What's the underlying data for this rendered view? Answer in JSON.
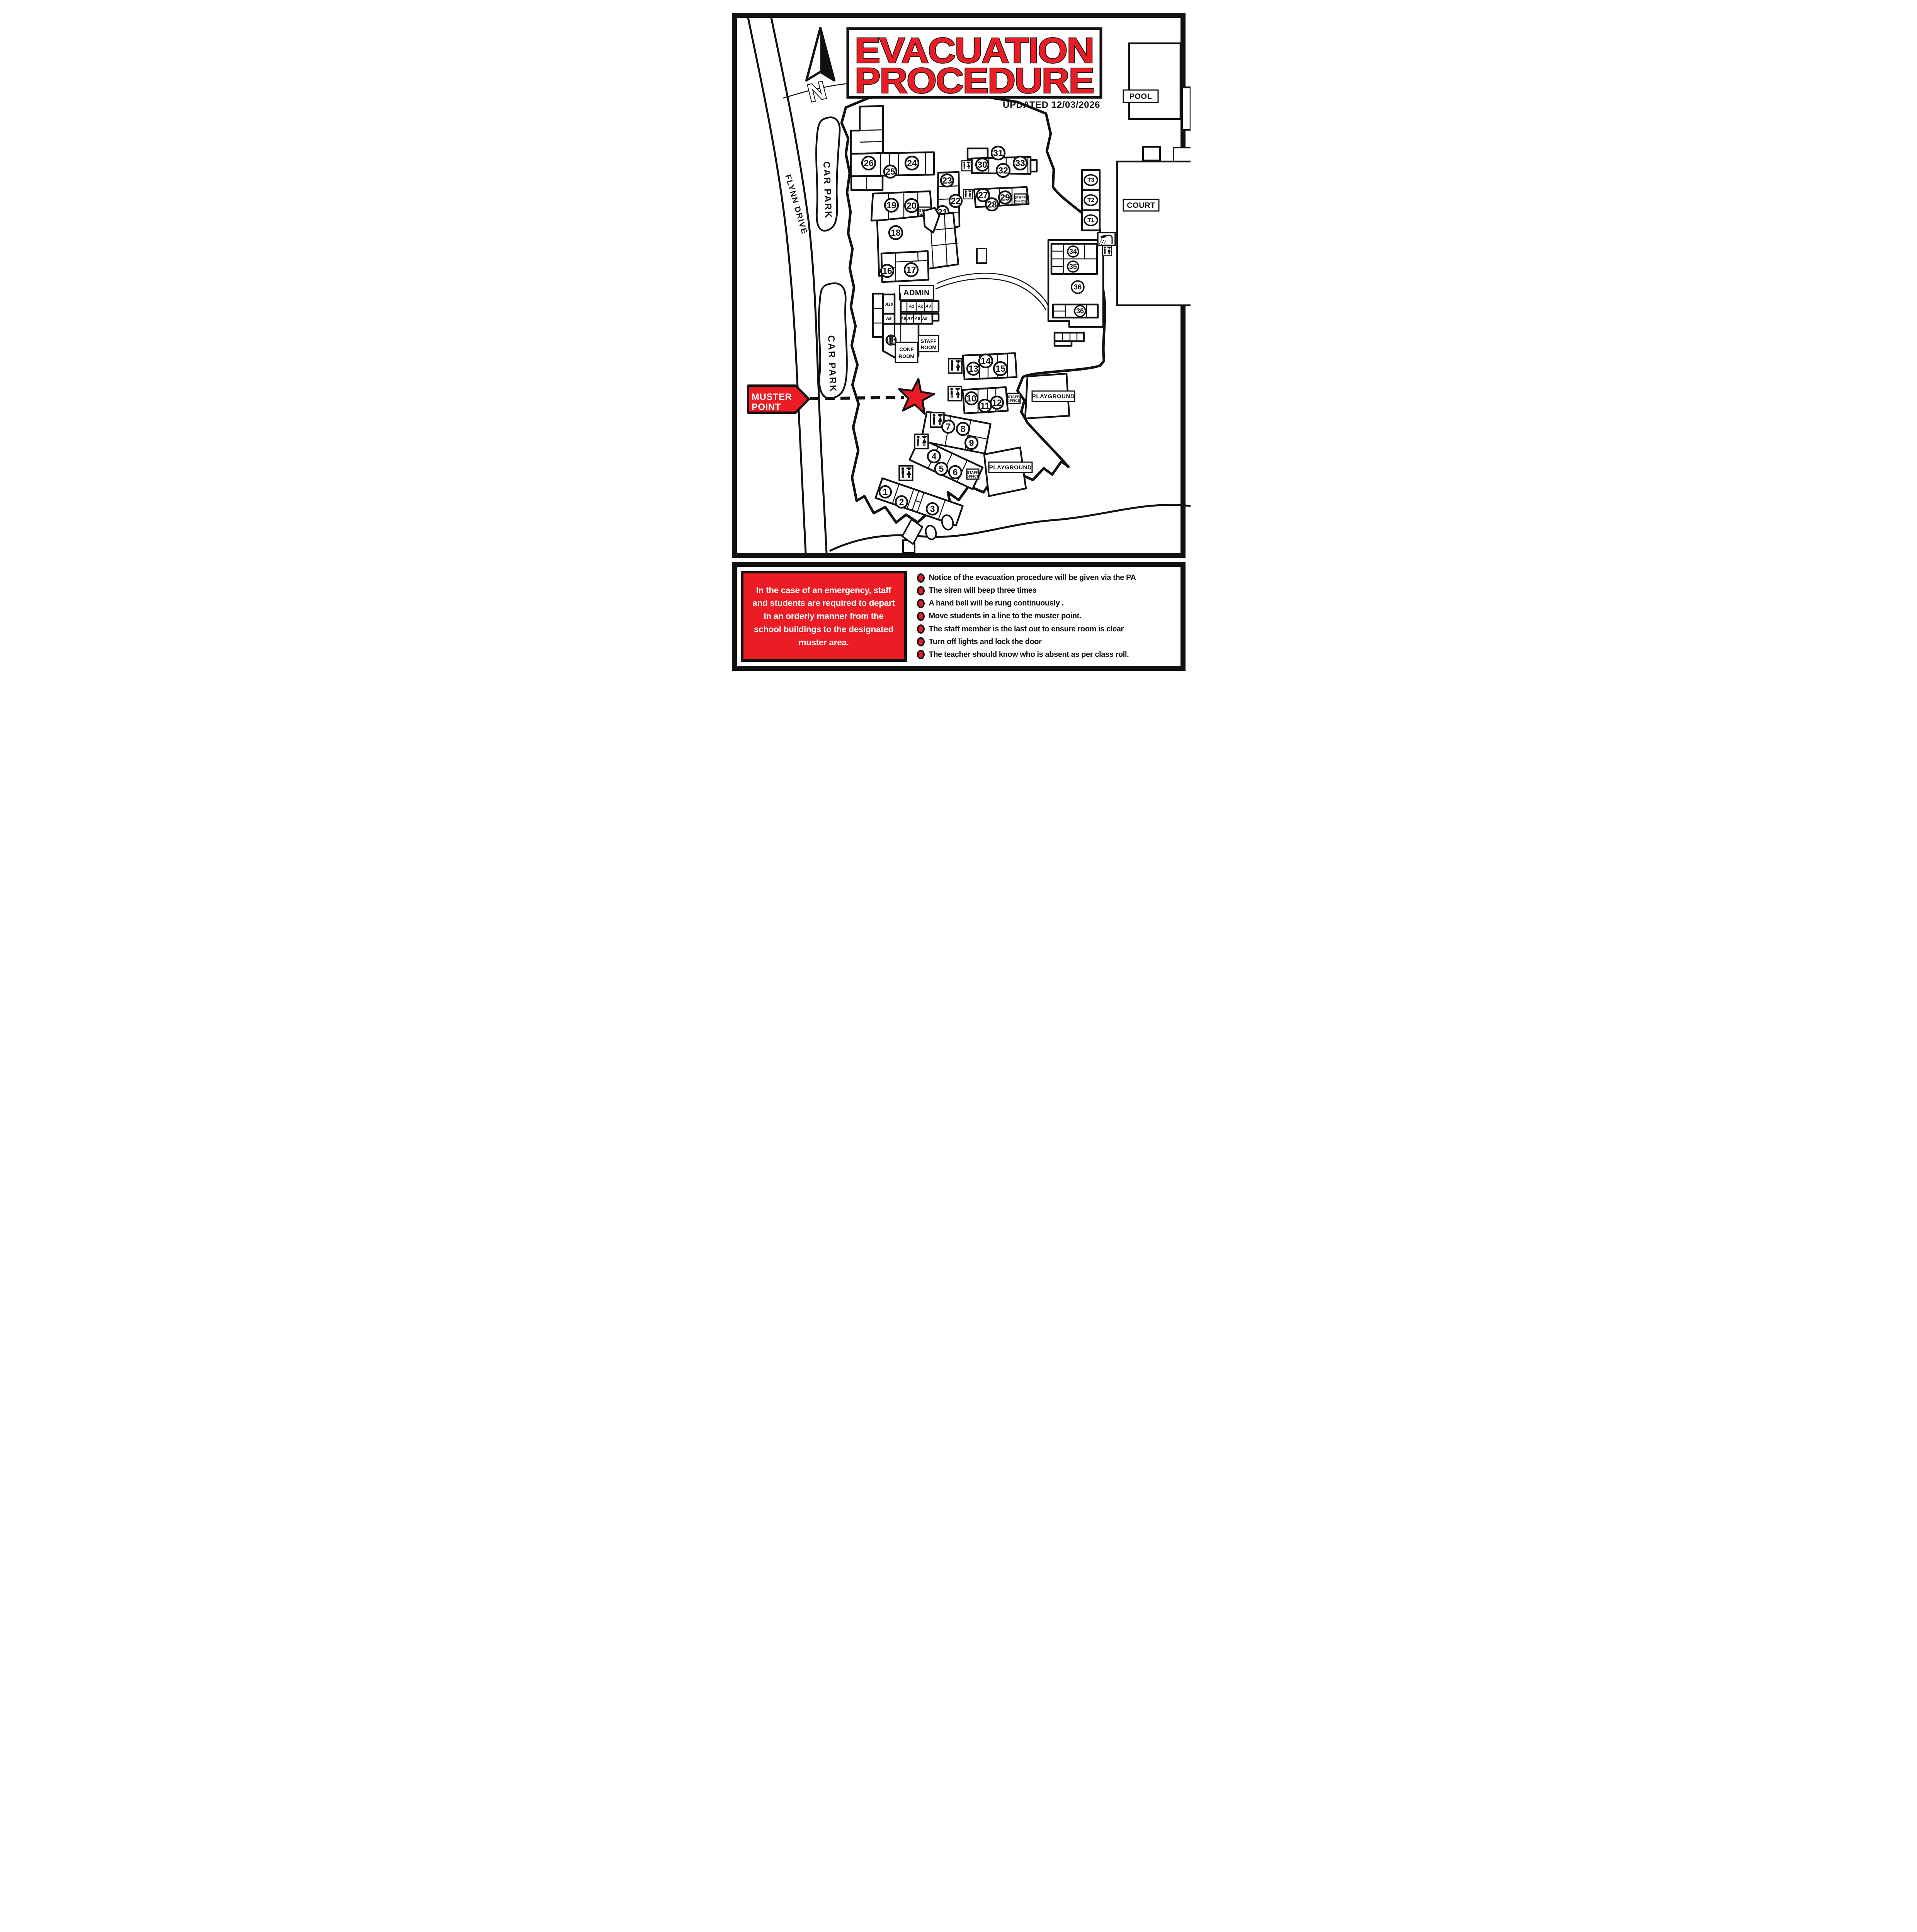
{
  "title": {
    "line1": "EVACUATION",
    "line2": "PROCEDURE",
    "updated": "UPDATED 12/03/2026"
  },
  "map": {
    "labels": {
      "north": "N",
      "pool": "POOL",
      "court": "COURT",
      "car_park": "CAR PARK",
      "flynn_drive": "FLYNN DRIVE",
      "admin": "ADMIN",
      "playground": "PLAYGROUND",
      "muster_line1": "MUSTER",
      "muster_line2": "POINT",
      "conf_line1": "CONF",
      "conf_line2": "ROOM",
      "staffroom_line1": "STAFF",
      "staffroom_line2": "ROOM",
      "staffoffice_line1": "STAFF",
      "staffoffice_line2": "OFFICE"
    },
    "rooms": {
      "n1": "1",
      "n2": "2",
      "n3": "3",
      "n4": "4",
      "n5": "5",
      "n6": "6",
      "n7": "7",
      "n8": "8",
      "n9": "9",
      "n10": "10",
      "n11": "11",
      "n12": "12",
      "n13": "13",
      "n14": "14",
      "n15": "15",
      "n16": "16",
      "n17": "17",
      "n18": "18",
      "n19": "19",
      "n20": "20",
      "n21": "21",
      "n22": "22",
      "n23": "23",
      "n24": "24",
      "n25": "25",
      "n26": "26",
      "n27": "27",
      "n28": "28",
      "n29": "29",
      "n30": "30",
      "n31": "31",
      "n32": "32",
      "n33": "33",
      "n34": "34",
      "n35": "35",
      "n36": "36",
      "n36b": "36",
      "t1": "T1",
      "t2": "T2",
      "t3": "T3"
    },
    "admin_rooms": {
      "a1": "A1",
      "a2": "A2",
      "a3": "A3",
      "a5": "A5",
      "a6": "A6",
      "a7": "A7",
      "a8": "A8",
      "a9": "A9",
      "a10": "A10"
    }
  },
  "notice": {
    "text": "In the case of an emergency, staff and students are required to depart in an orderly manner from the school buildings to the designated muster area."
  },
  "procedures": {
    "items": [
      "Notice of the evacuation procedure will be given via the PA",
      "The siren will beep three times",
      "A hand bell will be rung continuously .",
      "Move students in a line to the muster point.",
      "The staff member is the last out to ensure room is clear",
      "Turn off lights and lock the door",
      "The teacher should know who is absent as per class roll."
    ]
  },
  "colors": {
    "accent_red": "#EC1C24",
    "ink": "#111111"
  }
}
